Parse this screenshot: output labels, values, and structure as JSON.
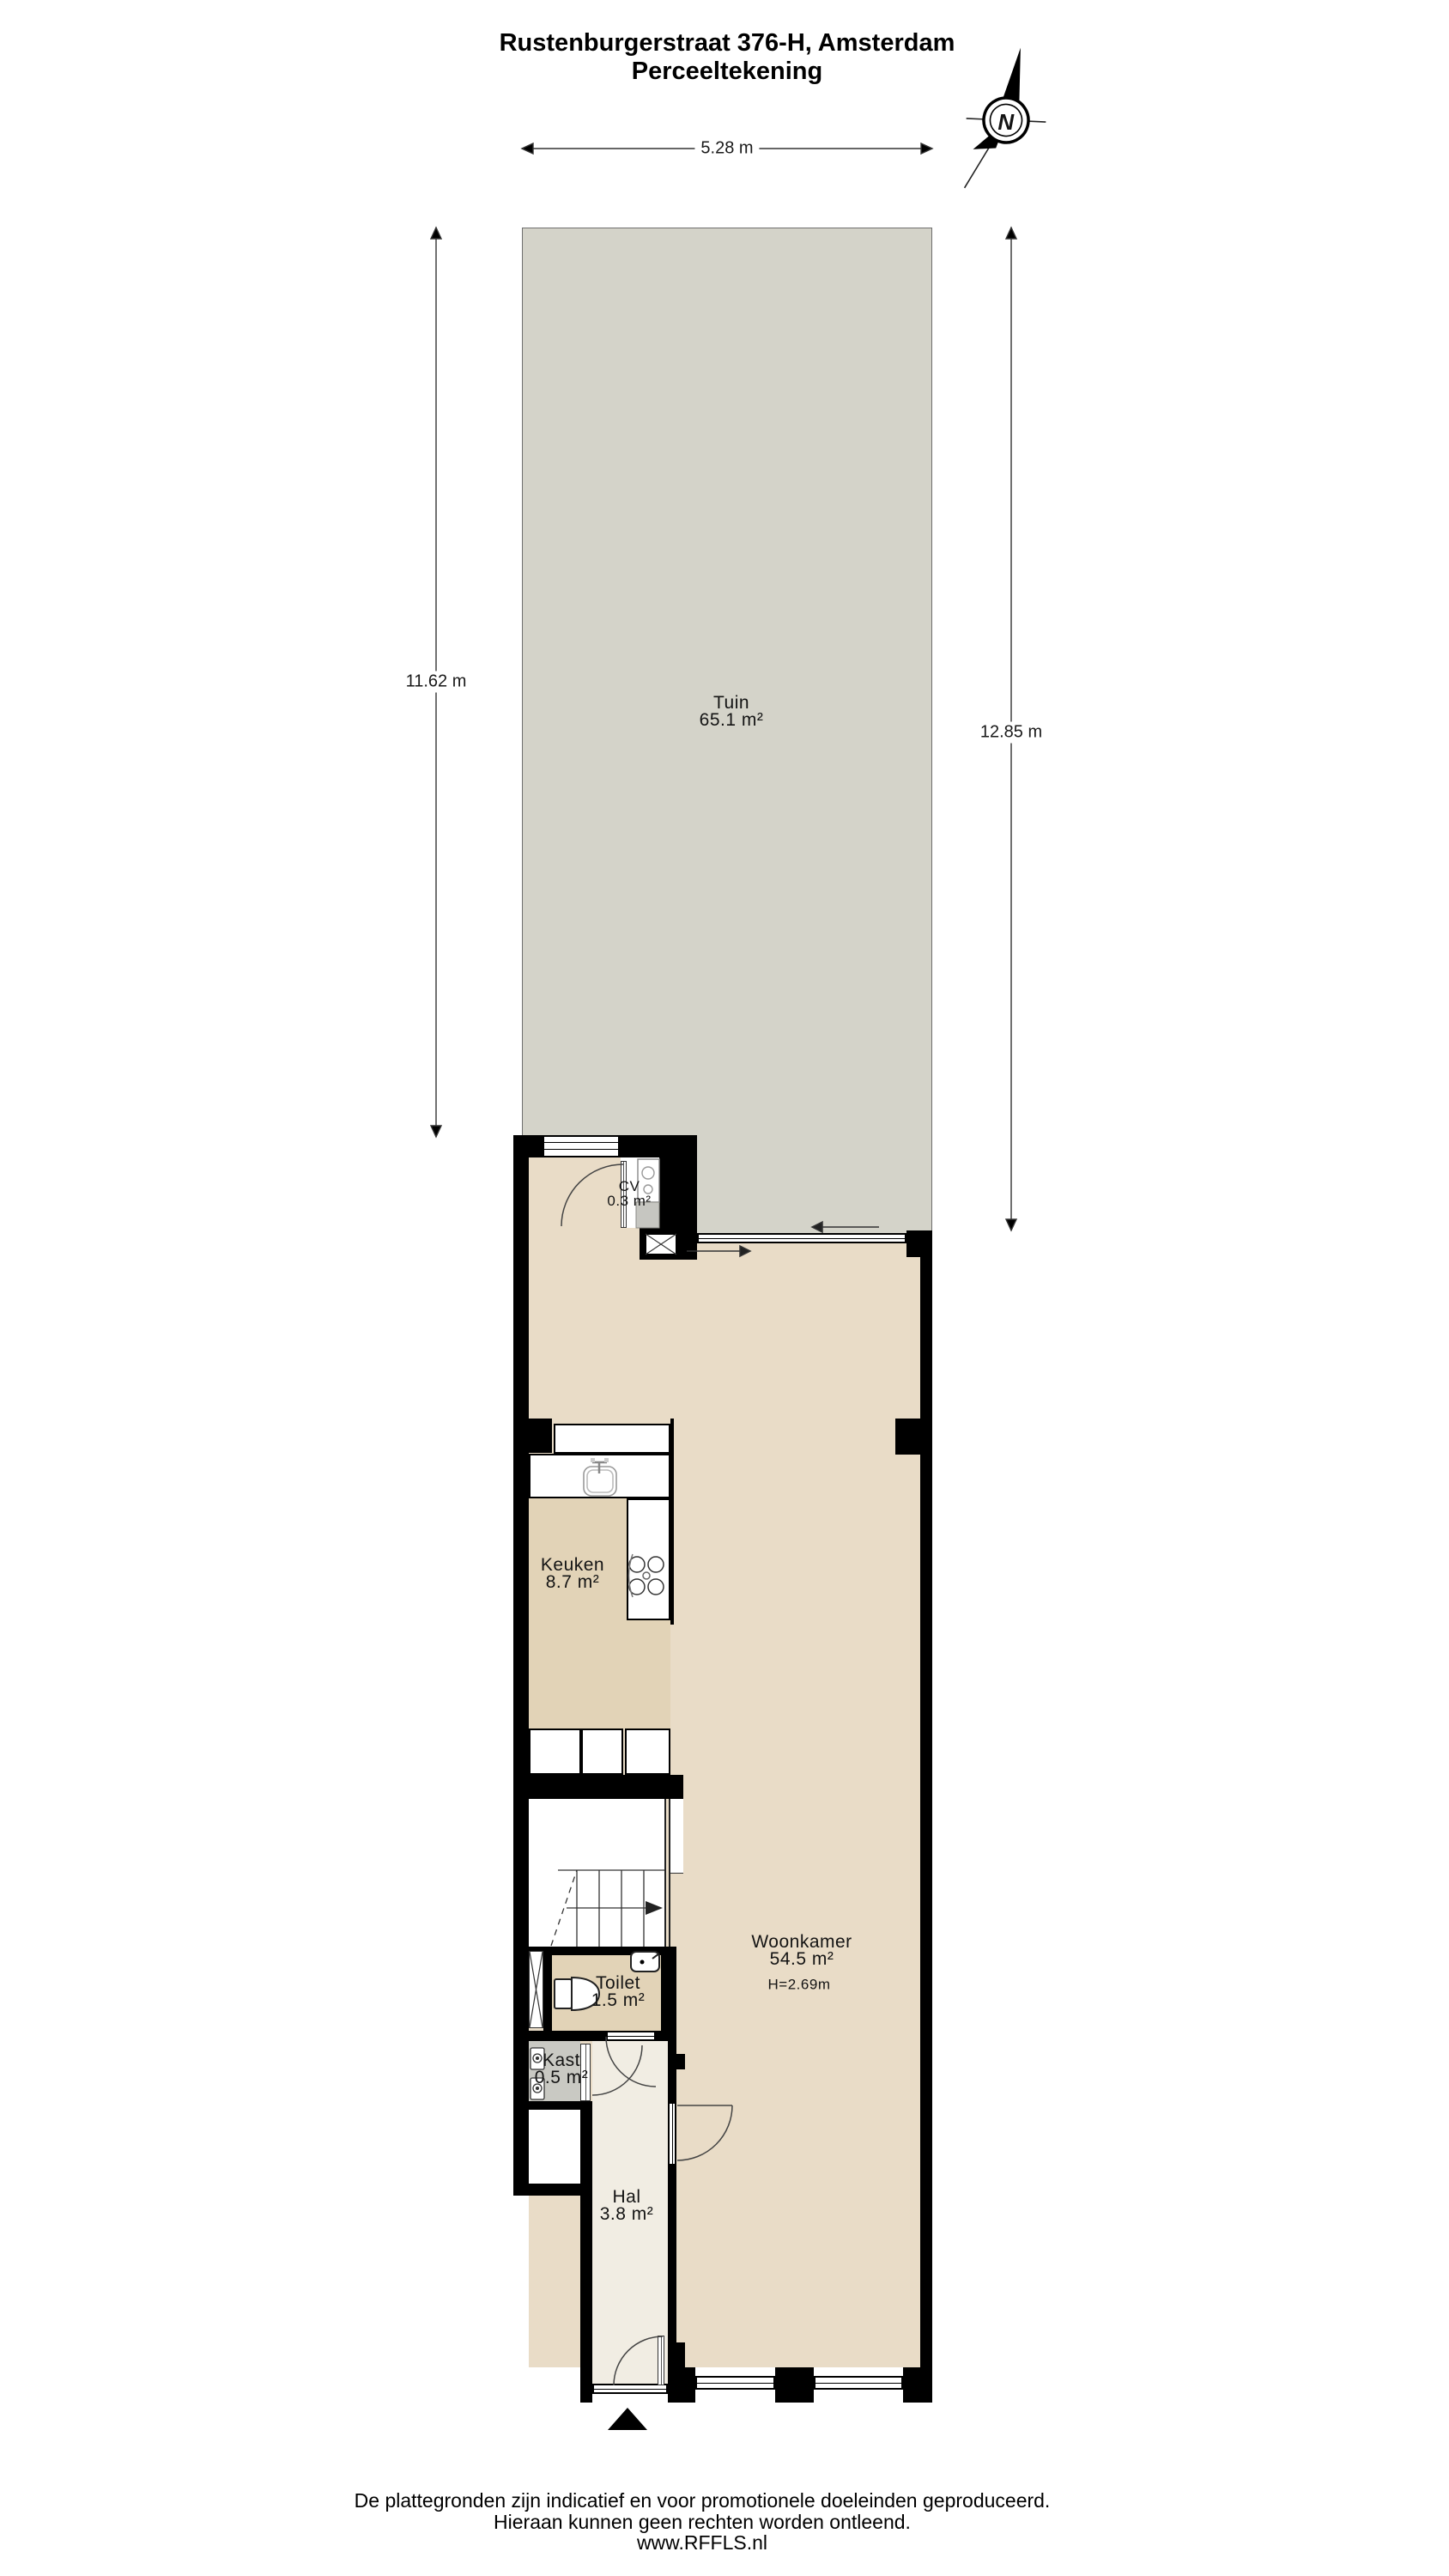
{
  "title": {
    "line1": "Rustenburgerstraat 376-H, Amsterdam",
    "line2": "Perceeltekening"
  },
  "compass": {
    "label": "N"
  },
  "dimensions": {
    "top": "5.28 m",
    "left": "11.62 m",
    "right": "12.85 m"
  },
  "rooms": {
    "tuin": {
      "name": "Tuin",
      "area": "65.1 m²"
    },
    "cv": {
      "name": "CV",
      "area": "0.3 m²"
    },
    "keuken": {
      "name": "Keuken",
      "area": "8.7 m²"
    },
    "woonkamer": {
      "name": "Woonkamer",
      "area": "54.5 m²",
      "ceiling_height": "H=2.69m"
    },
    "toilet": {
      "name": "Toilet",
      "area": "1.5 m²"
    },
    "kast": {
      "name": "Kast",
      "area": "0.5 m²"
    },
    "hal": {
      "name": "Hal",
      "area": "3.8 m²"
    }
  },
  "footer": {
    "line1": "De plattegronden zijn indicatief en voor promotionele doeleinden geproduceerd.",
    "line2": "Hieraan kunnen geen rechten worden ontleend.",
    "line3": "www.RFFLS.nl"
  },
  "colors": {
    "garden": "#d4d3c9",
    "living_floor": "#e9dcc7",
    "service_floor": "#e2d3b7",
    "closet_floor": "#c9c9c3",
    "hall_floor": "#f1ede3",
    "wall": "#000000"
  }
}
